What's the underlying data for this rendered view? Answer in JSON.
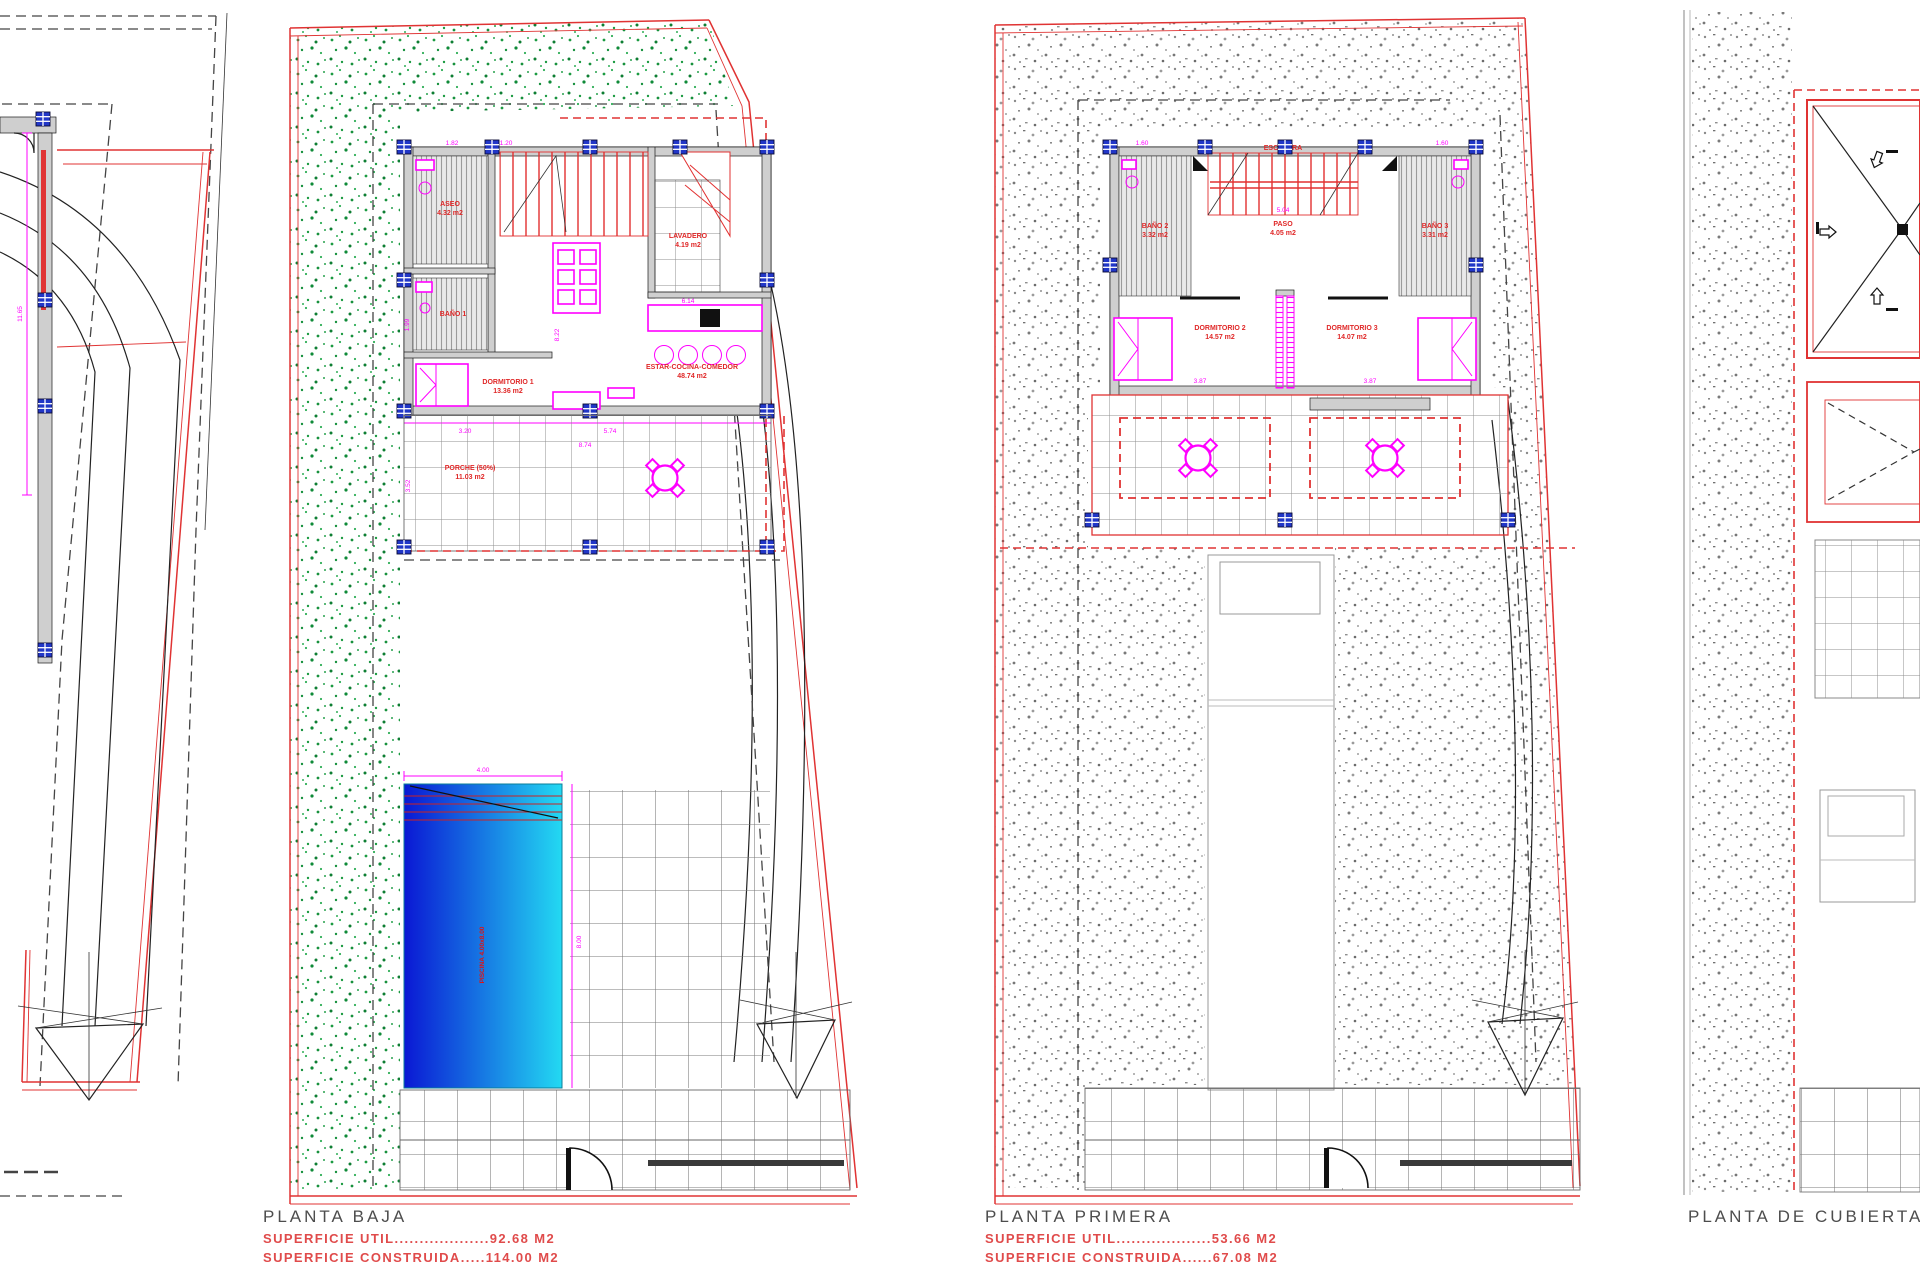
{
  "sheet": {
    "background": "#ffffff",
    "kind": "architectural-floor-plans"
  },
  "colors": {
    "plot_red": "#e03333",
    "furniture_magenta": "#ff00ff",
    "dim_magenta": "#ff00ff",
    "wall_gray": "#cfcfcf",
    "anchor_blue": "#2136c7",
    "garden_green": "#1c9b42",
    "gravel_gray": "#8a8a8a",
    "pool_deep": "#0a18d4",
    "pool_shallow": "#23d9f2",
    "title_gray": "#4d4d4d",
    "label_red": "#e02828"
  },
  "plans": {
    "site": {
      "name": "site-access-plan",
      "dims": {
        "wall_length": "11.65"
      }
    },
    "planta_baja": {
      "title": "PLANTA BAJA",
      "superficie_util": "SUPERFICIE UTIL...................92.68 M2",
      "superficie_construida": "SUPERFICIE CONSTRUIDA.....114.00 M2",
      "rooms": {
        "aseo": {
          "label": "ASEO",
          "area": "4.32 m2"
        },
        "bano1": {
          "label": "BAÑO 1"
        },
        "lavadero": {
          "label": "LAVADERO",
          "area": "4.19 m2"
        },
        "dormitorio1": {
          "label": "DORMITORIO 1",
          "area": "13.36 m2"
        },
        "estar": {
          "label": "ESTAR-COCINA-COMEDOR",
          "area": "48.74 m2"
        },
        "porche": {
          "label": "PORCHE (50%)",
          "area": "11.03 m2"
        },
        "piscina": {
          "label": "PISCINA 4.00x8.00"
        }
      },
      "dims": {
        "d_bed": "3.20",
        "d_living": "5.74",
        "d_house": "8.74",
        "d_porch": "3.52",
        "d_aseo": "1.82",
        "d_stair": "1.20",
        "d_hall": "1.99",
        "d_kitchen": "6.14",
        "d_depth": "8.22",
        "pool_w": "4.00",
        "pool_l": "8.00"
      }
    },
    "planta_primera": {
      "title": "PLANTA PRIMERA",
      "superficie_util": "SUPERFICIE UTIL...................53.66 M2",
      "superficie_construida": "SUPERFICIE CONSTRUIDA......67.08 M2",
      "rooms": {
        "escalera": {
          "label": "ESCALERA"
        },
        "bano2": {
          "label": "BAÑO 2",
          "area": "3.32 m2"
        },
        "bano3": {
          "label": "BAÑO 3",
          "area": "3.31 m2"
        },
        "paso": {
          "label": "PASO",
          "area": "4.05 m2"
        },
        "dormitorio2": {
          "label": "DORMITORIO 2",
          "area": "14.57 m2"
        },
        "dormitorio3": {
          "label": "DORMITORIO 3",
          "area": "14.07 m2"
        }
      },
      "dims": {
        "d_bano2": "1.60",
        "d_bano3": "1.60",
        "d_dorm2": "3.87",
        "d_dorm3": "3.87",
        "d_paso": "5.04"
      }
    },
    "planta_cubierta": {
      "title": "PLANTA DE CUBIERTA"
    }
  }
}
